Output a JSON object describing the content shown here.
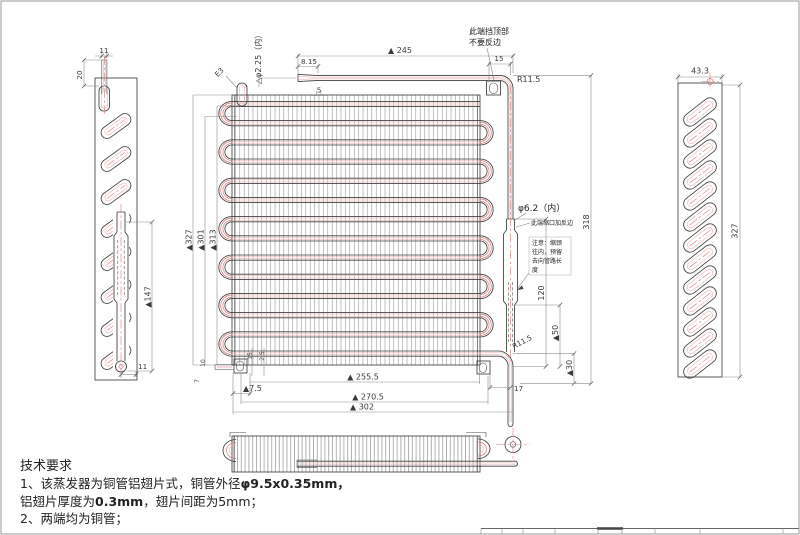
{
  "annotations": {
    "top1": "此端挡顶部",
    "top2": "不要反边",
    "phi_inlet": "△φ2.25（内）",
    "e3": "E3",
    "phi_outlet": "φ6.2（内）",
    "neck": "此端缩口加反边",
    "c1": "注意：缩颈",
    "c2": "往内，预留",
    "c3": "去向管路长",
    "c4": "度"
  },
  "dims": {
    "stub_w": "11",
    "stub_h": "20",
    "tube147": "▲147",
    "bot11": "11",
    "len245": "▲ 245",
    "flare": "8.15",
    "pitch5": "5",
    "off15": "15",
    "r11top": "R11.5",
    "h327": "▲327",
    "h301": "▲301",
    "h313": "▲313",
    "acc120": "120",
    "acc50": "▲50",
    "out30": "▲30",
    "h318": "318",
    "r11bot": "R11.5",
    "out17": "17",
    "w2555": "▲ 255.5",
    "w2705": "▲ 270.5",
    "w302": "▲ 302",
    "off75": "▲7.5",
    "s15": "15",
    "s25": "2.5",
    "s10": "10",
    "s7": "7",
    "rv_w": "43.3",
    "rv_h": "327"
  },
  "tech": {
    "title": "技术要求",
    "l1a": "1、该蒸发器为铜管铝翅片式，铜管外径",
    "l1b": "φ9.5x0.35mm，",
    "l2a": "铝翅片厚度为",
    "l2b": "0.3mm",
    "l2c": "，翅片间距为5mm；",
    "l3": "2、两端均为铜管；"
  },
  "colors": {
    "line": "#3f3f3f",
    "tube_red": "#d97878",
    "tube_red_light": "#eeb0b0",
    "dim_line": "#8a8a8a",
    "fin": "#8d8d8d"
  }
}
